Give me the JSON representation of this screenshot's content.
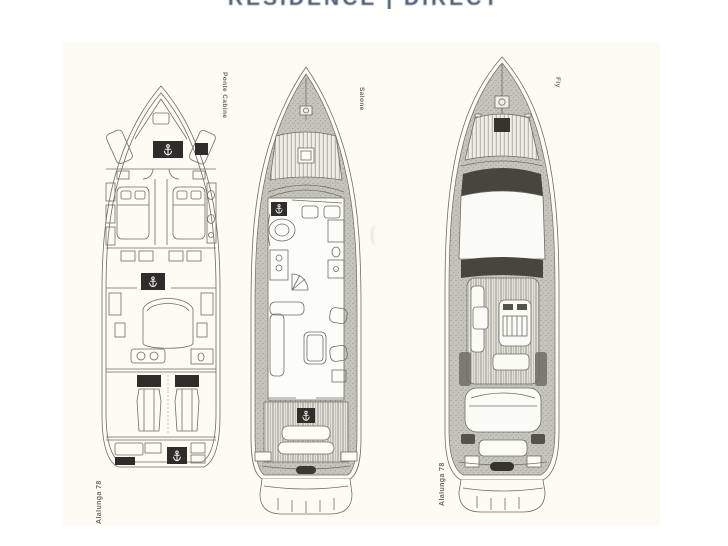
{
  "header": {
    "watermark": "RESIDENCE | DIRECT"
  },
  "sheet": {
    "plans": [
      {
        "deck_label": "Ponte Cabine",
        "model_label": "Alalunga 78",
        "deck": "lower-deck-cabins"
      },
      {
        "deck_label": "Salone",
        "model_label": "",
        "deck": "main-deck-salon"
      },
      {
        "deck_label": "Fly",
        "model_label": "Alalunga 78",
        "deck": "flybridge-deck"
      }
    ]
  },
  "icons": {
    "stairs_marker": "anchor-icon"
  },
  "colors": {
    "watermark": "#3d4e66",
    "paper": "#fcfbf4",
    "line_ink": "#6e6d66",
    "dark_fill": "#2e2d29",
    "deck_texture": "#c6c5bd"
  }
}
